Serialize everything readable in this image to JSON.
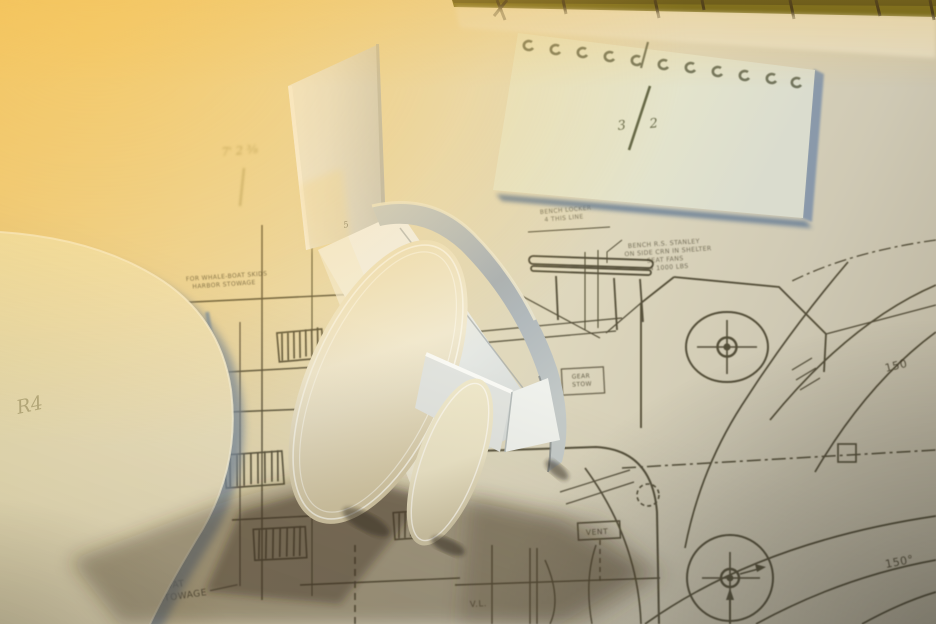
{
  "scene_labels": {
    "angle_150": "150",
    "angle_150_deg": "150°",
    "vent": "VENT",
    "vertical_line": "V.L.",
    "skids_note_line1": "FOR WHALE-BOAT SKIDS",
    "skids_note_line2": "HARBOR STOWAGE",
    "stowage_note_line1": "FOR WHALEBOAT",
    "stowage_note_line2": "AT HARBOR STOWAGE",
    "bench_note_line1": "BENCH LOCKER",
    "bench_note_line2": "4 THIS LINE",
    "shelter_note_line1": "BENCH R.S. STANLEY",
    "shelter_note_line2": "ON SIDE CRN IN SHELTER",
    "shelter_note_line3": "SEAT FANS",
    "shelter_note_line4": "4 1000 LBS",
    "gear_box_line1": "GEAR",
    "gear_box_line2": "STOW"
  },
  "handwriting": {
    "dimension_note": "7' 2 ⅜",
    "template_r4": "R4",
    "fin_mark": "5",
    "fraction_numerator": "3",
    "fraction_denominator": "2"
  },
  "colors": {
    "paper_warm": "#eec873",
    "paper_mid": "#e8ddb9",
    "paper_cool": "#b3ac98",
    "blueprint_line": "#3d3724",
    "ruler_band": "#55530f",
    "model_white": "#f2f1ea",
    "model_cream_edge": "#eadfb6",
    "model_blue_wall": "#a8b0b5",
    "card_shadow_blue": "#7d90a8",
    "pencil_olive": "#5d6148"
  }
}
